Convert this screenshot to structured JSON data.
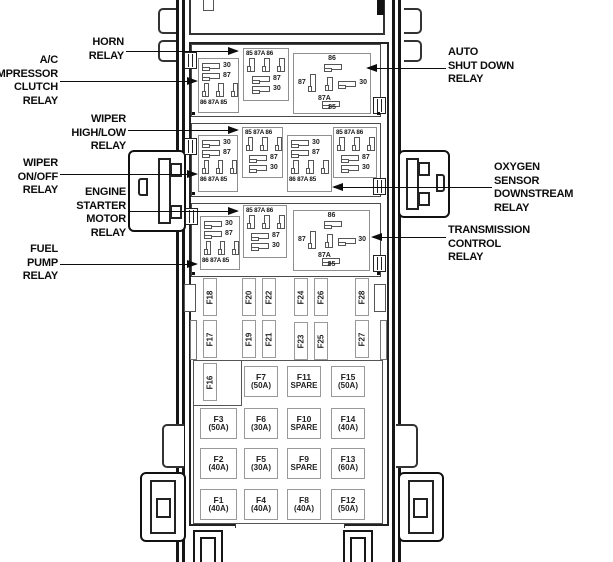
{
  "diagram_type": "power-distribution-center-fuse-relay-diagram",
  "colors": {
    "background": "#ffffff",
    "line": "#161616",
    "box_border": "#444444",
    "relay_border": "#8f8f8f",
    "fuse_border": "#999999",
    "text": "#111111"
  },
  "labels": {
    "left": [
      "HORN\nRELAY",
      "A/C\nOMPRESSOR\nCLUTCH\nRELAY",
      "WIPER\nHIGH/LOW\nRELAY",
      "WIPER\nON/OFF\nRELAY",
      "ENGINE\nSTARTER\nMOTOR\nRELAY",
      "FUEL\nPUMP\nRELAY"
    ],
    "right": [
      "AUTO\nSHUT DOWN\nRELAY",
      "OXYGEN\nSENSOR\nDOWNSTREAM\nRELAY",
      "TRANSMISSION\nCONTROL\nRELAY"
    ]
  },
  "relay_pins": {
    "a": {
      "r30": "30",
      "r87": "87",
      "bottom": "86 87A 85"
    },
    "b": {
      "top": "85 87A 86",
      "r87": "87",
      "r30": "30"
    },
    "c": {
      "t86": "86",
      "l87": "87",
      "c87a": "87A",
      "r30": "30",
      "b85": "85"
    }
  },
  "fuses": {
    "f16": "F16",
    "vertical_top": [
      "F18",
      "F20",
      "F22",
      "F24",
      "F26",
      "F28"
    ],
    "vertical_bottom": [
      "F17",
      "F19",
      "F21",
      "F23",
      "F25",
      "F27"
    ],
    "grid_rows": [
      [
        {
          "name": "F7",
          "rating": "(50A)"
        },
        {
          "name": "F11",
          "rating": "SPARE"
        },
        {
          "name": "F15",
          "rating": "(50A)"
        }
      ],
      [
        {
          "name": "F3",
          "rating": "(50A)"
        },
        {
          "name": "F6",
          "rating": "(30A)"
        },
        {
          "name": "F10",
          "rating": "SPARE"
        },
        {
          "name": "F14",
          "rating": "(40A)"
        }
      ],
      [
        {
          "name": "F2",
          "rating": "(40A)"
        },
        {
          "name": "F5",
          "rating": "(30A)"
        },
        {
          "name": "F9",
          "rating": "SPARE"
        },
        {
          "name": "F13",
          "rating": "(60A)"
        }
      ],
      [
        {
          "name": "F1",
          "rating": "(40A)"
        },
        {
          "name": "F4",
          "rating": "(40A)"
        },
        {
          "name": "F8",
          "rating": "(40A)"
        },
        {
          "name": "F12",
          "rating": "(50A)"
        }
      ]
    ]
  }
}
